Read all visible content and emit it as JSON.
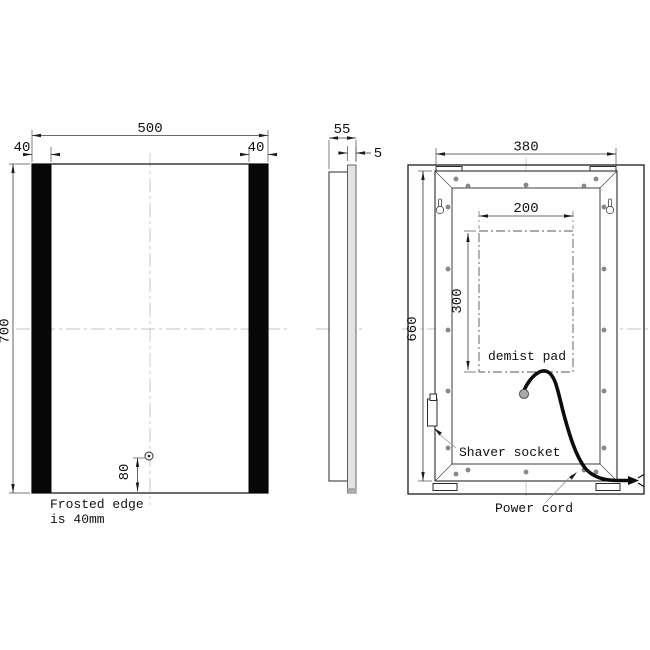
{
  "drawing": {
    "title": "LED mirror technical drawing, three views",
    "front": {
      "width_label": "500",
      "height_label": "700",
      "frost_left_label": "40",
      "frost_right_label": "40",
      "sensor_offset_label": "80",
      "note_line1": "Frosted edge",
      "note_line2": "is 40mm"
    },
    "side": {
      "depth_label": "55",
      "glass_label": "5"
    },
    "back": {
      "frame_width_label": "380",
      "frame_height_label": "660",
      "pad_width_label": "200",
      "pad_height_label": "300",
      "pad_label": "demist pad",
      "shaver_label": "Shaver socket",
      "cord_label": "Power cord"
    },
    "colors": {
      "line": "#1c1c1c",
      "centerline": "#c3c3c3",
      "frosted_bar": "#070707",
      "screw": "#8d8d8d",
      "connector": "#a9a9a9"
    }
  }
}
